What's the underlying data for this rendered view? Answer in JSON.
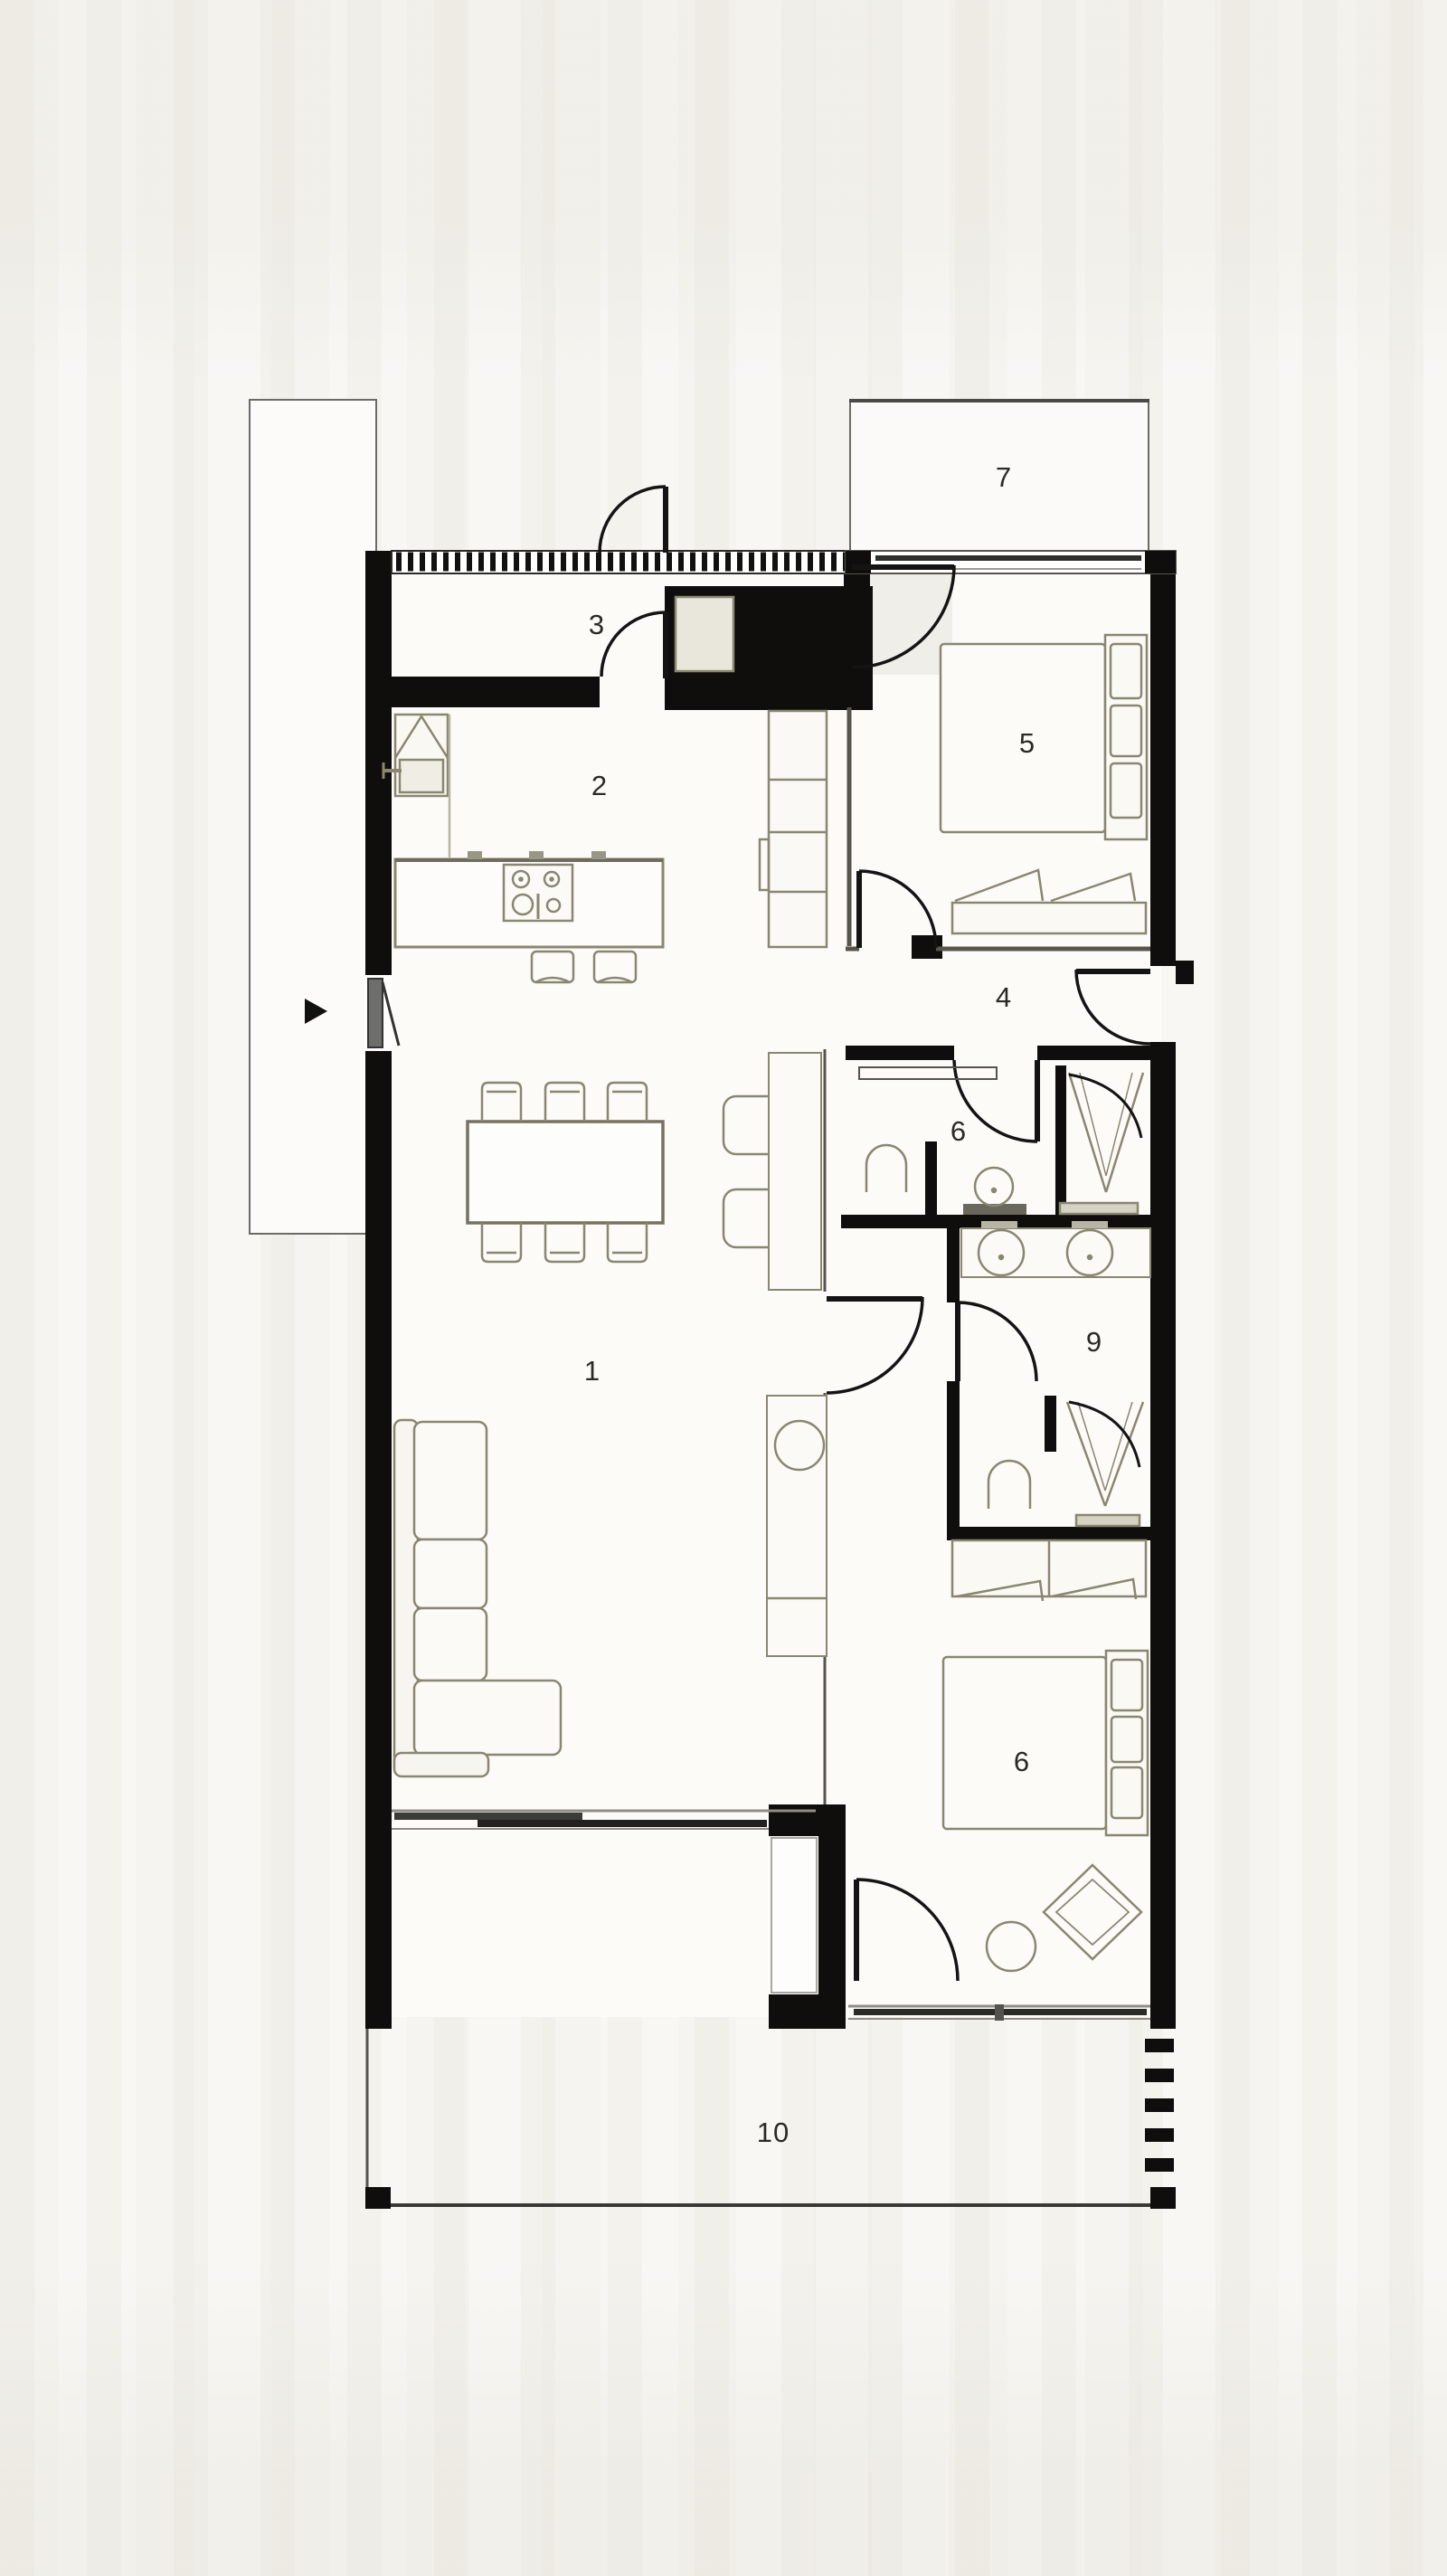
{
  "plan": {
    "type": "architectural-floor-plan",
    "units_shown": "none",
    "rooms": [
      {
        "id": "living-dining",
        "label": "1"
      },
      {
        "id": "kitchen",
        "label": "2"
      },
      {
        "id": "entry-hall",
        "label": "3"
      },
      {
        "id": "hallway",
        "label": "4"
      },
      {
        "id": "bedroom-top",
        "label": "5"
      },
      {
        "id": "bathroom",
        "label": "6"
      },
      {
        "id": "porch",
        "label": "7"
      },
      {
        "id": "ensuite",
        "label": "9"
      },
      {
        "id": "bedroom-bottom",
        "label": "6"
      },
      {
        "id": "terrace",
        "label": "10"
      }
    ],
    "colors": {
      "paper": "#f8f7f4",
      "wall": "#0f0e0c",
      "furniture_line": "#8a8672",
      "furniture_fill": "#f6f4ee",
      "window_frame": "#8f8d86",
      "glazing_bar": "#2c2b28",
      "label_text": "#2b2a27",
      "closet_fill": "#e9e6db"
    },
    "icons": [
      "entry-arrow-icon",
      "door-swing-arc",
      "shower-drain-symbol",
      "cooktop-burners",
      "sink-basin"
    ]
  }
}
